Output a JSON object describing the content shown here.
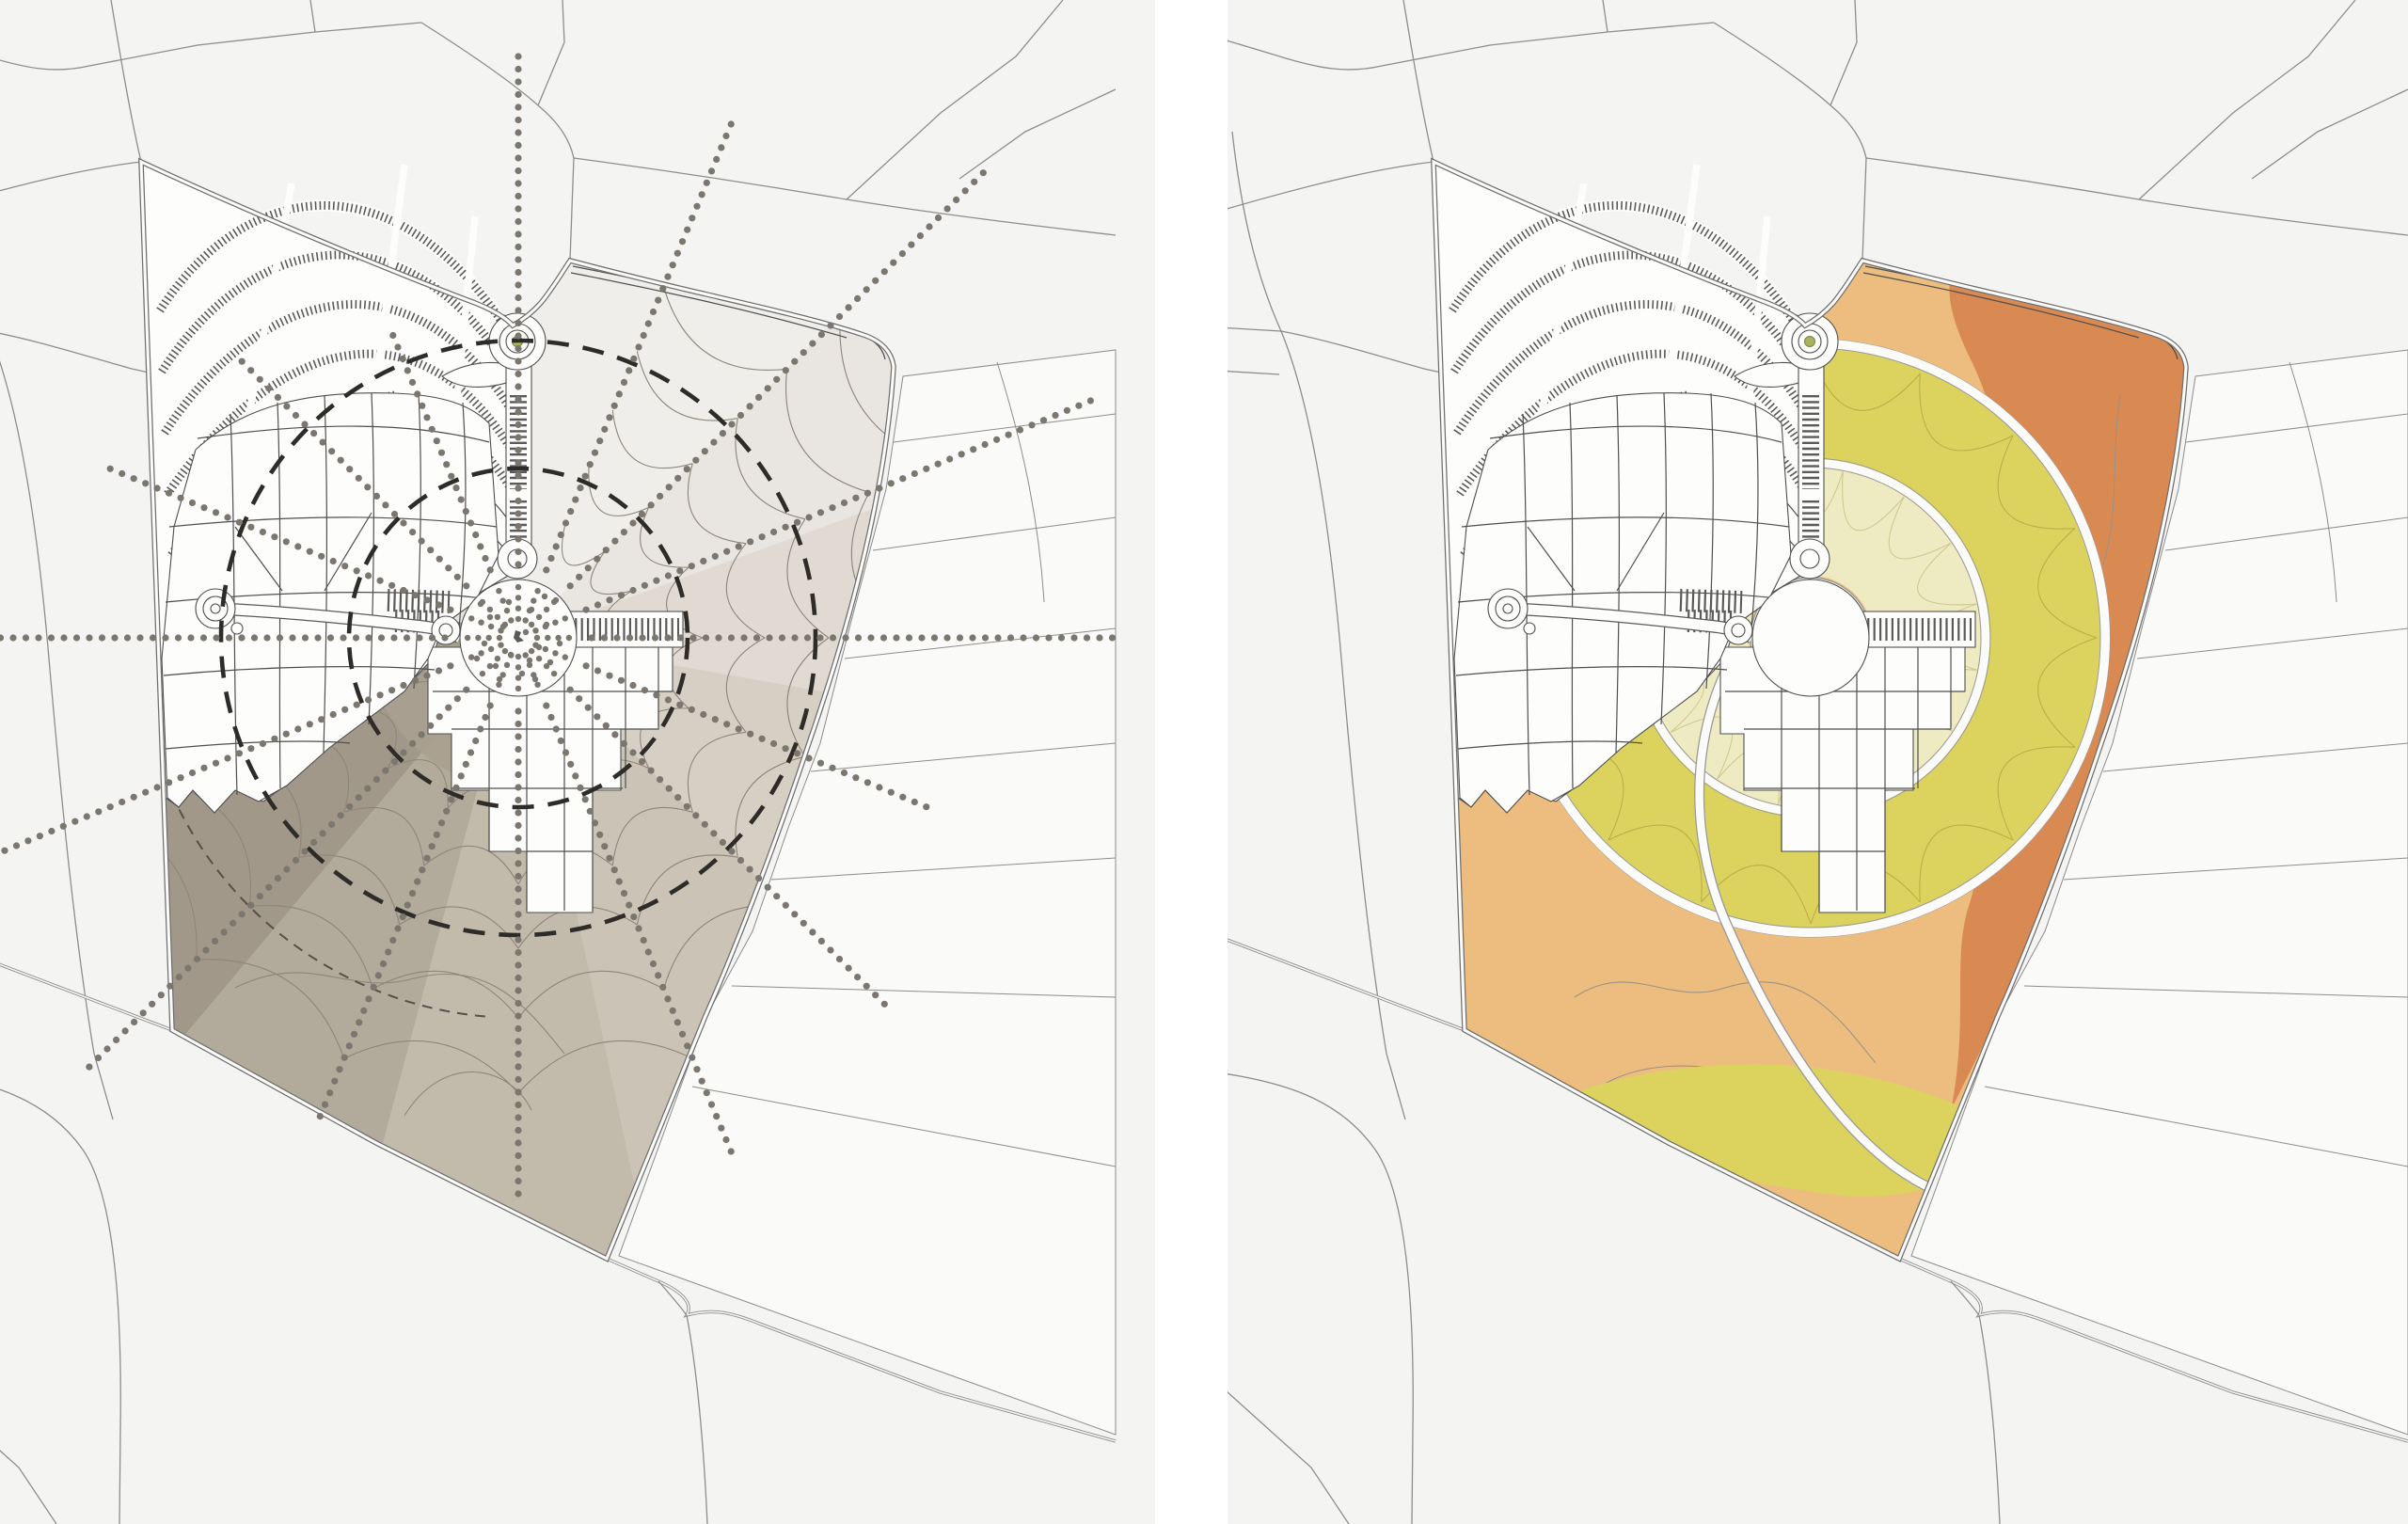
{
  "document": {
    "kind": "urban-masterplan-analysis-diagram-pair",
    "visible_text": [],
    "panel_count": 2
  },
  "palette": {
    "page_bg": "#ffffff",
    "panel_bg": "#f4f4f3",
    "ctx_line": "#8d8d8c",
    "fields": "#fafaf9",
    "bnd": "#6f6f6f",
    "road_core": "#fbfbfa",
    "plan_line": "#4f4f4f",
    "plan_white": "#fdfdfc",
    "hatch": "#5a5a5a",
    "dash": "#2e2c29",
    "dash_thin": "#55504a",
    "contour_line": "#9b9285",
    "ring_edge": "#9a9a9a",
    "dot": "#7b776f",
    "petal_left": "#8d8679",
    "green_marker": "#a9b25c",
    "green_marker_edge": "#7b8440",
    "center_mark": "#5a5a5a",
    "left_base": "#e7e3dd",
    "inner_fan": "#a9a090",
    "right_base": "#edbd80",
    "right_dark_band": "#d98a52",
    "right_yellow": "#dcd35f",
    "right_pale": "#eeebc2",
    "right_tongue": "#dcd35f",
    "petal_outer_right": "#b9ae49",
    "petal_inner_right": "#cfc98f"
  },
  "left_overlay": {
    "center": [
      551,
      678
    ],
    "plaza_radius": 62,
    "dashed_circle_radii": [
      180,
      316
    ],
    "thin_dashed_arc": {
      "r": 404,
      "a0": 95,
      "a1": 175
    },
    "ray_dot": {
      "radius": 3.6,
      "gap": 13.5,
      "start": 78
    },
    "inner_ray": {
      "start": 20,
      "end": 56,
      "gap": 11.3,
      "radius": 3.2
    },
    "rays": [
      {
        "a": 0.0,
        "len": 640
      },
      {
        "a": 22.5,
        "len": 470
      },
      {
        "a": 45.0,
        "len": 560
      },
      {
        "a": 67.5,
        "len": 600
      },
      {
        "a": 90.0,
        "len": 592
      },
      {
        "a": 112.5,
        "len": 560
      },
      {
        "a": 135.0,
        "len": 650
      },
      {
        "a": 157.5,
        "len": 640
      },
      {
        "a": 180.0,
        "len": 560
      },
      {
        "a": 202.5,
        "len": 470
      },
      {
        "a": 225.0,
        "len": 420
      },
      {
        "a": 247.5,
        "len": 360
      },
      {
        "a": 270.0,
        "len": 620
      },
      {
        "a": 292.5,
        "len": 600
      },
      {
        "a": 315.0,
        "len": 700
      },
      {
        "a": 337.5,
        "len": 660
      }
    ],
    "plaza_scatter": [
      [
        -10,
        -38
      ],
      [
        14,
        -30
      ],
      [
        -30,
        -22
      ],
      [
        30,
        -14
      ],
      [
        -16,
        -12
      ],
      [
        8,
        -6
      ],
      [
        -36,
        6
      ],
      [
        22,
        10
      ],
      [
        -8,
        18
      ],
      [
        34,
        26
      ],
      [
        -24,
        30
      ],
      [
        4,
        38
      ],
      [
        18,
        44
      ],
      [
        -40,
        -36
      ],
      [
        40,
        -40
      ],
      [
        -44,
        22
      ],
      [
        44,
        6
      ],
      [
        12,
        24
      ],
      [
        -20,
        44
      ],
      [
        28,
        -44
      ]
    ],
    "wedges": [
      {
        "a0": -90,
        "a1": -45,
        "color": "#f0eeeb"
      },
      {
        "a0": -45,
        "a1": -20,
        "color": "#e9e5e0"
      },
      {
        "a0": -20,
        "a1": 10,
        "color": "#e0dad2"
      },
      {
        "a0": 10,
        "a1": 45,
        "color": "#d6cfc4"
      },
      {
        "a0": 45,
        "a1": 78,
        "color": "#cbc4b6"
      },
      {
        "a0": 78,
        "a1": 105,
        "color": "#c2baab"
      },
      {
        "a0": 105,
        "a1": 130,
        "color": "#b2aa9a"
      },
      {
        "a0": 130,
        "a1": 158,
        "color": "#a1988a"
      },
      {
        "a0": 158,
        "a1": 195,
        "color": "#938b7c"
      },
      {
        "a0": 195,
        "a1": 270,
        "color": "#e7e3dd"
      }
    ],
    "inner_fan": {
      "a0": 90,
      "a1": 180,
      "r": 160
    },
    "petal_rings": [
      [
        62,
        130
      ],
      [
        130,
        196
      ],
      [
        196,
        262
      ],
      [
        262,
        330
      ],
      [
        330,
        404
      ],
      [
        404,
        484
      ]
    ],
    "petal_sectors": {
      "a0": -67.5,
      "a1": 192,
      "step": 22.5
    }
  },
  "right_overlay": {
    "center": [
      551,
      678
    ],
    "plaza_radius": 64,
    "inner_zone_radii": [
      66,
      184
    ],
    "outer_zone_radii": [
      188,
      308
    ],
    "ring_road_radii": [
      186,
      313
    ],
    "petal_step_deg": 22.5
  },
  "icons": {
    "roundabout_marker": "green-dot",
    "plaza_center_marker": "dark-splat"
  }
}
